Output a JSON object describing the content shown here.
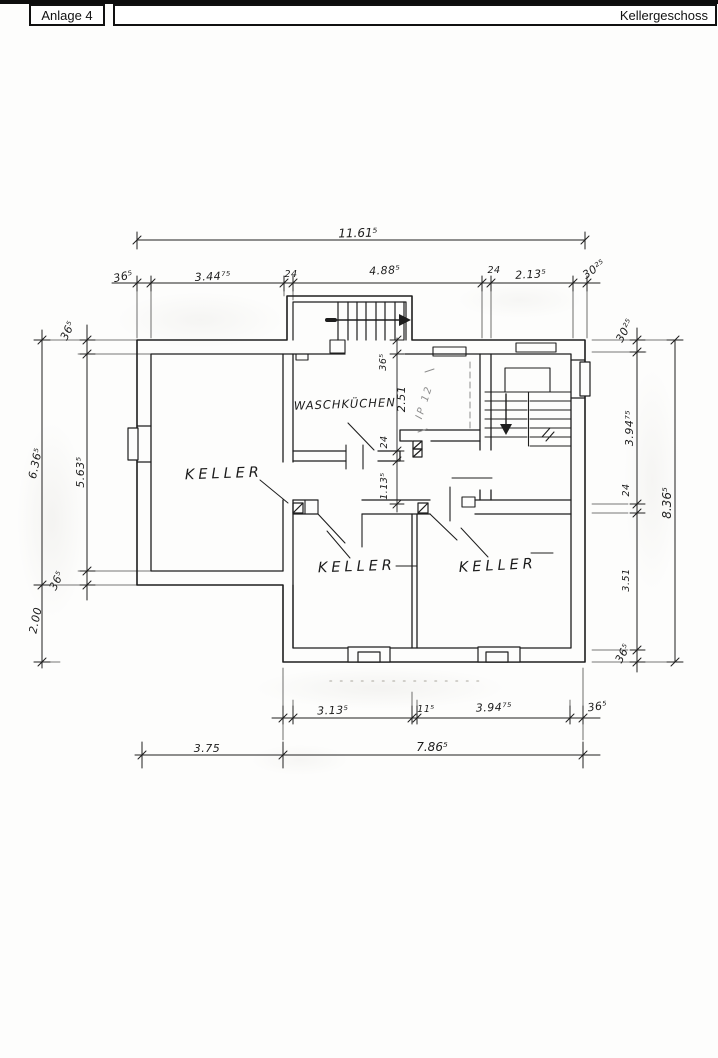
{
  "header": {
    "left_label": "Anlage 4",
    "right_label": "Kellergeschoss"
  },
  "rooms": {
    "keller_left": "KELLER",
    "waschkueche": "WASCHKÜCHEN",
    "keller_middle": "KELLER",
    "keller_right": "KELLER"
  },
  "annotations": {
    "beam_label": "IP 12"
  },
  "dims": {
    "top_total": "11.61⁵",
    "top_chain": [
      "36⁵",
      "3.44⁷⁵",
      "24",
      "4.88⁵",
      "24",
      "2.13⁵",
      "30²⁵"
    ],
    "left_outer": [
      "6.36⁵",
      "2.00"
    ],
    "left_chain": [
      "36⁵",
      "5.63⁵",
      "36⁵"
    ],
    "right_total": "8.36⁵",
    "right_chain": [
      "30²⁵",
      "3.94⁷⁵",
      "24",
      "3.51",
      "36⁵"
    ],
    "center_chain": [
      "36⁵",
      "2.51",
      "24",
      "1.13⁵"
    ],
    "bottom_chain": [
      "3.13⁵",
      "11⁵",
      "3.94⁷⁵",
      "36⁵"
    ],
    "bottom_totals": [
      "3.75",
      "7.86⁵"
    ]
  },
  "colors": {
    "ink": "#1e1e1e",
    "pencil": "#8d8d8d",
    "paper": "#fdfdfc"
  }
}
